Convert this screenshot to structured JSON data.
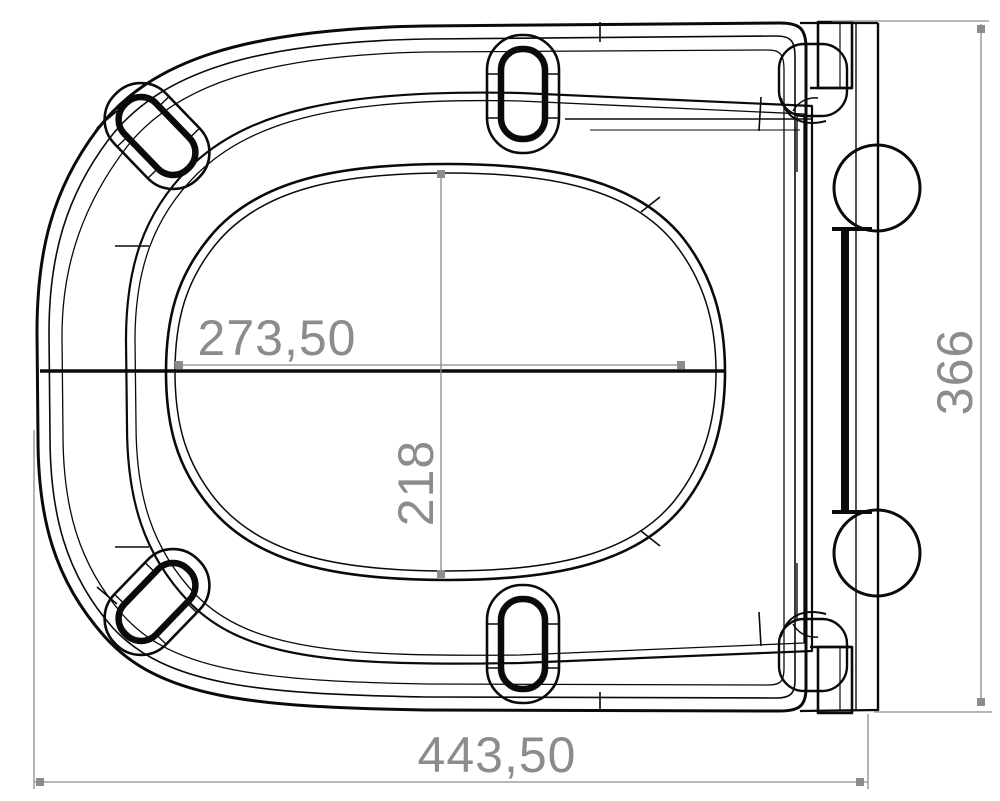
{
  "drawing": {
    "kind": "technical-drawing-top-view",
    "background": "#ffffff",
    "line_color": "#0a0a0a",
    "dimension_color": "#8c8c8c"
  },
  "dims": {
    "inner_width": "273,50",
    "inner_depth": "218",
    "side_height": "366",
    "overall_width": "443,50"
  }
}
